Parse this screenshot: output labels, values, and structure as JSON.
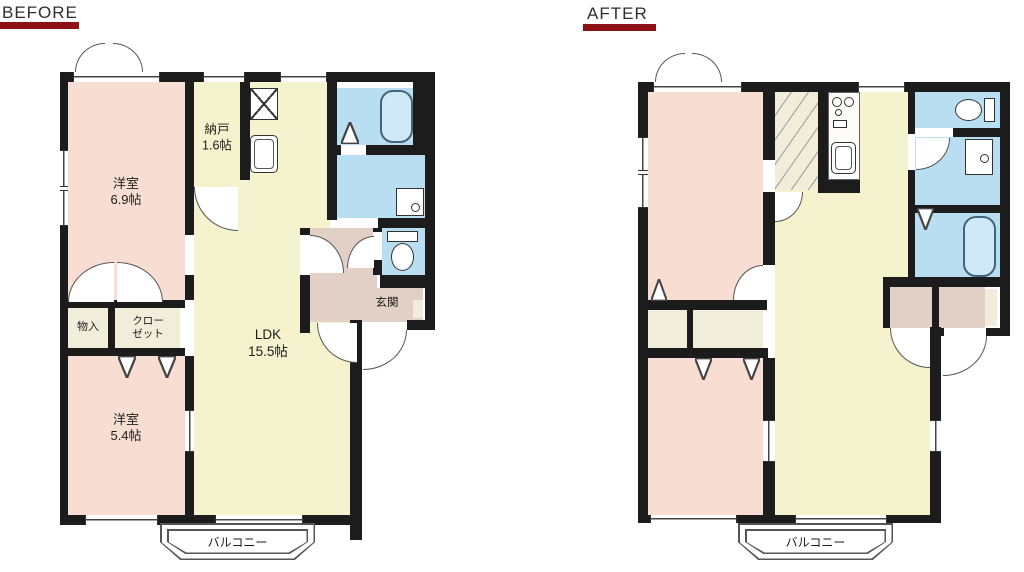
{
  "header": {
    "before_label": "BEFORE",
    "after_label": "AFTER"
  },
  "before_plan": {
    "bedroom1_line1": "洋室",
    "bedroom1_line2": "6.9帖",
    "nando_line1": "納戸",
    "nando_line2": "1.6帖",
    "ldk_line1": "LDK",
    "ldk_line2": "15.5帖",
    "monoire": "物入",
    "closet_line1": "クロー",
    "closet_line2": "ゼット",
    "genkan": "玄関",
    "bedroom2_line1": "洋室",
    "bedroom2_line2": "5.4帖",
    "balcony": "バルコニー"
  },
  "after_plan": {
    "balcony": "バルコニー"
  },
  "colors": {
    "wall": "#1c1c1c",
    "room_pink": "#f8ded2",
    "room_yellow": "#f5f3cd",
    "room_blue": "#b9def1",
    "hall_pink": "#e2cfc6",
    "closet_cream": "#f2edda",
    "tub_fill": "#cfe9f7",
    "underline": "#8c1014"
  }
}
